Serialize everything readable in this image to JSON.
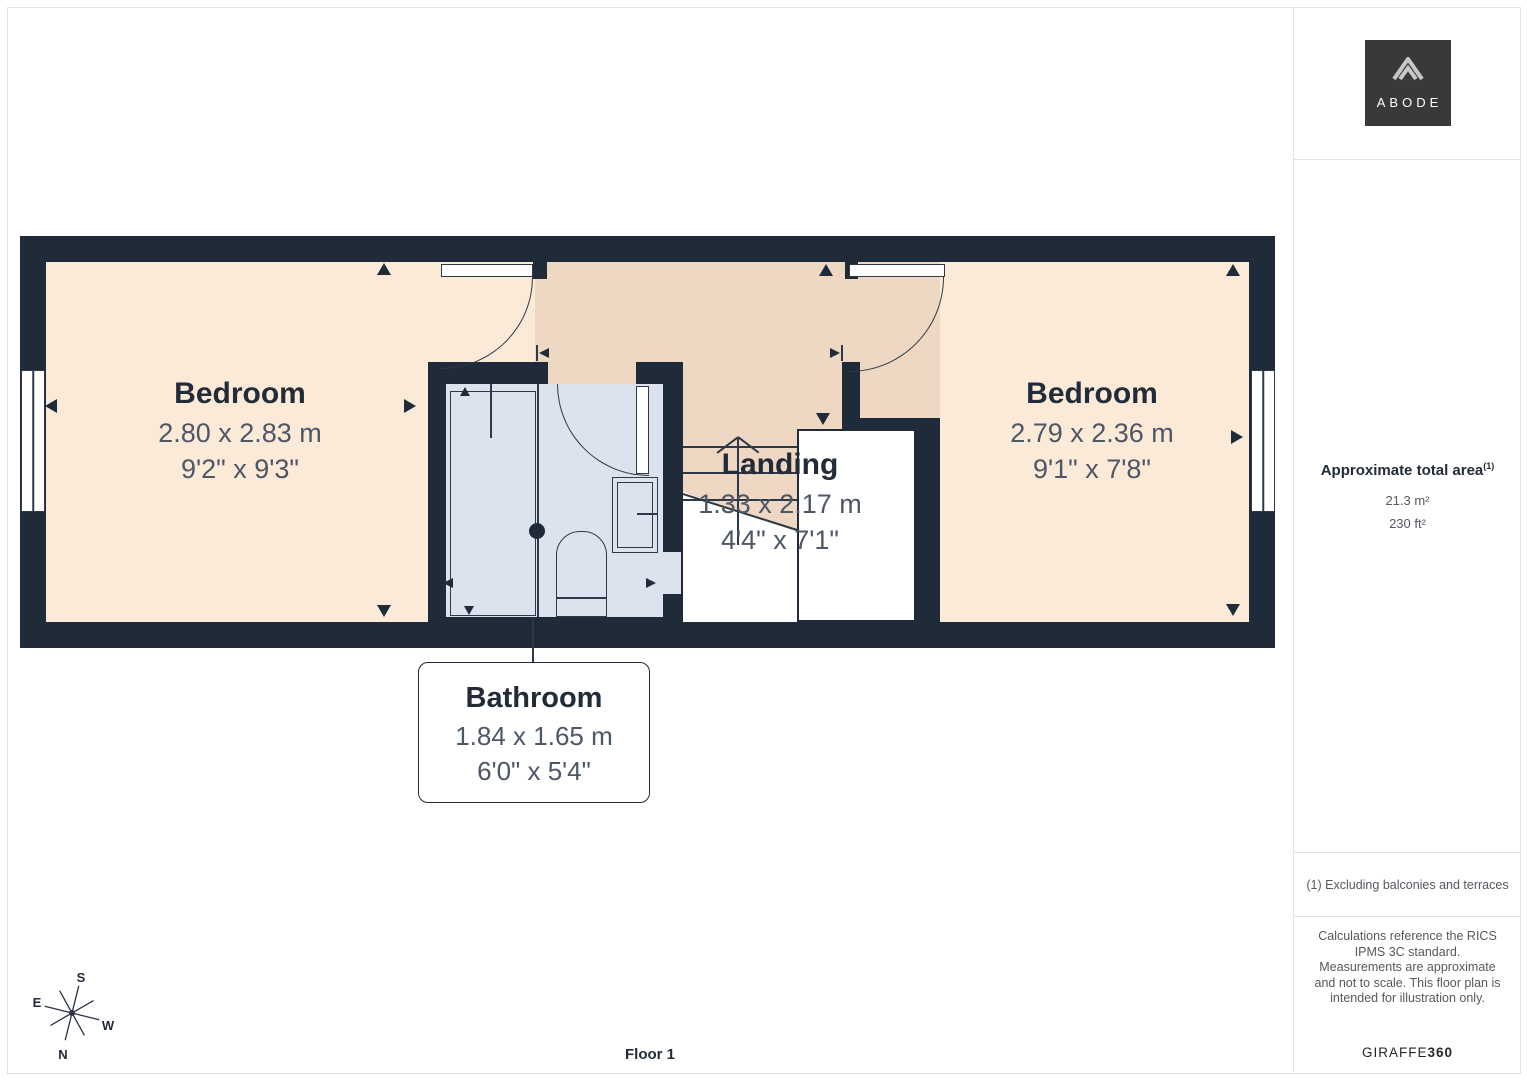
{
  "page": {
    "floor_label": "Floor 1"
  },
  "logo": {
    "text": "ABODE"
  },
  "sidebar": {
    "area_title": "Approximate total area",
    "area_sup": "(1)",
    "area_metric": "21.3 m²",
    "area_imperial": "230 ft²",
    "footnote": "(1) Excluding balconies and terraces",
    "disclaimer": "Calculations reference the RICS IPMS 3C standard. Measurements are approximate and not to scale. This floor plan is intended for illustration only.",
    "brand": "GIRAFFE",
    "brand_bold": "360"
  },
  "rooms": {
    "bedroom_left": {
      "name": "Bedroom",
      "metric": "2.80 x 2.83 m",
      "imperial": "9'2\" x 9'3\""
    },
    "bedroom_right": {
      "name": "Bedroom",
      "metric": "2.79 x 2.36 m",
      "imperial": "9'1\" x 7'8\""
    },
    "landing": {
      "name": "Landing",
      "metric": "1.33 x 2.17 m",
      "imperial": "4'4\" x 7'1\""
    },
    "bathroom": {
      "name": "Bathroom",
      "metric": "1.84 x 1.65 m",
      "imperial": "6'0\" x 5'4\""
    }
  },
  "compass": {
    "n": "N",
    "e": "E",
    "s": "S",
    "w": "W"
  },
  "colors": {
    "wall": "#202b39",
    "bedroom-floor": "#fcead9",
    "landing-floor": "#eed7c3",
    "bathroom-floor": "#dce3ef",
    "line": "#2e3947",
    "label": "#222b38",
    "dim": "#4d5765",
    "muted": "#55585f",
    "divider": "#e4e4e4",
    "logo-bg": "#39393b",
    "logo-fg": "#c8c8ca"
  }
}
